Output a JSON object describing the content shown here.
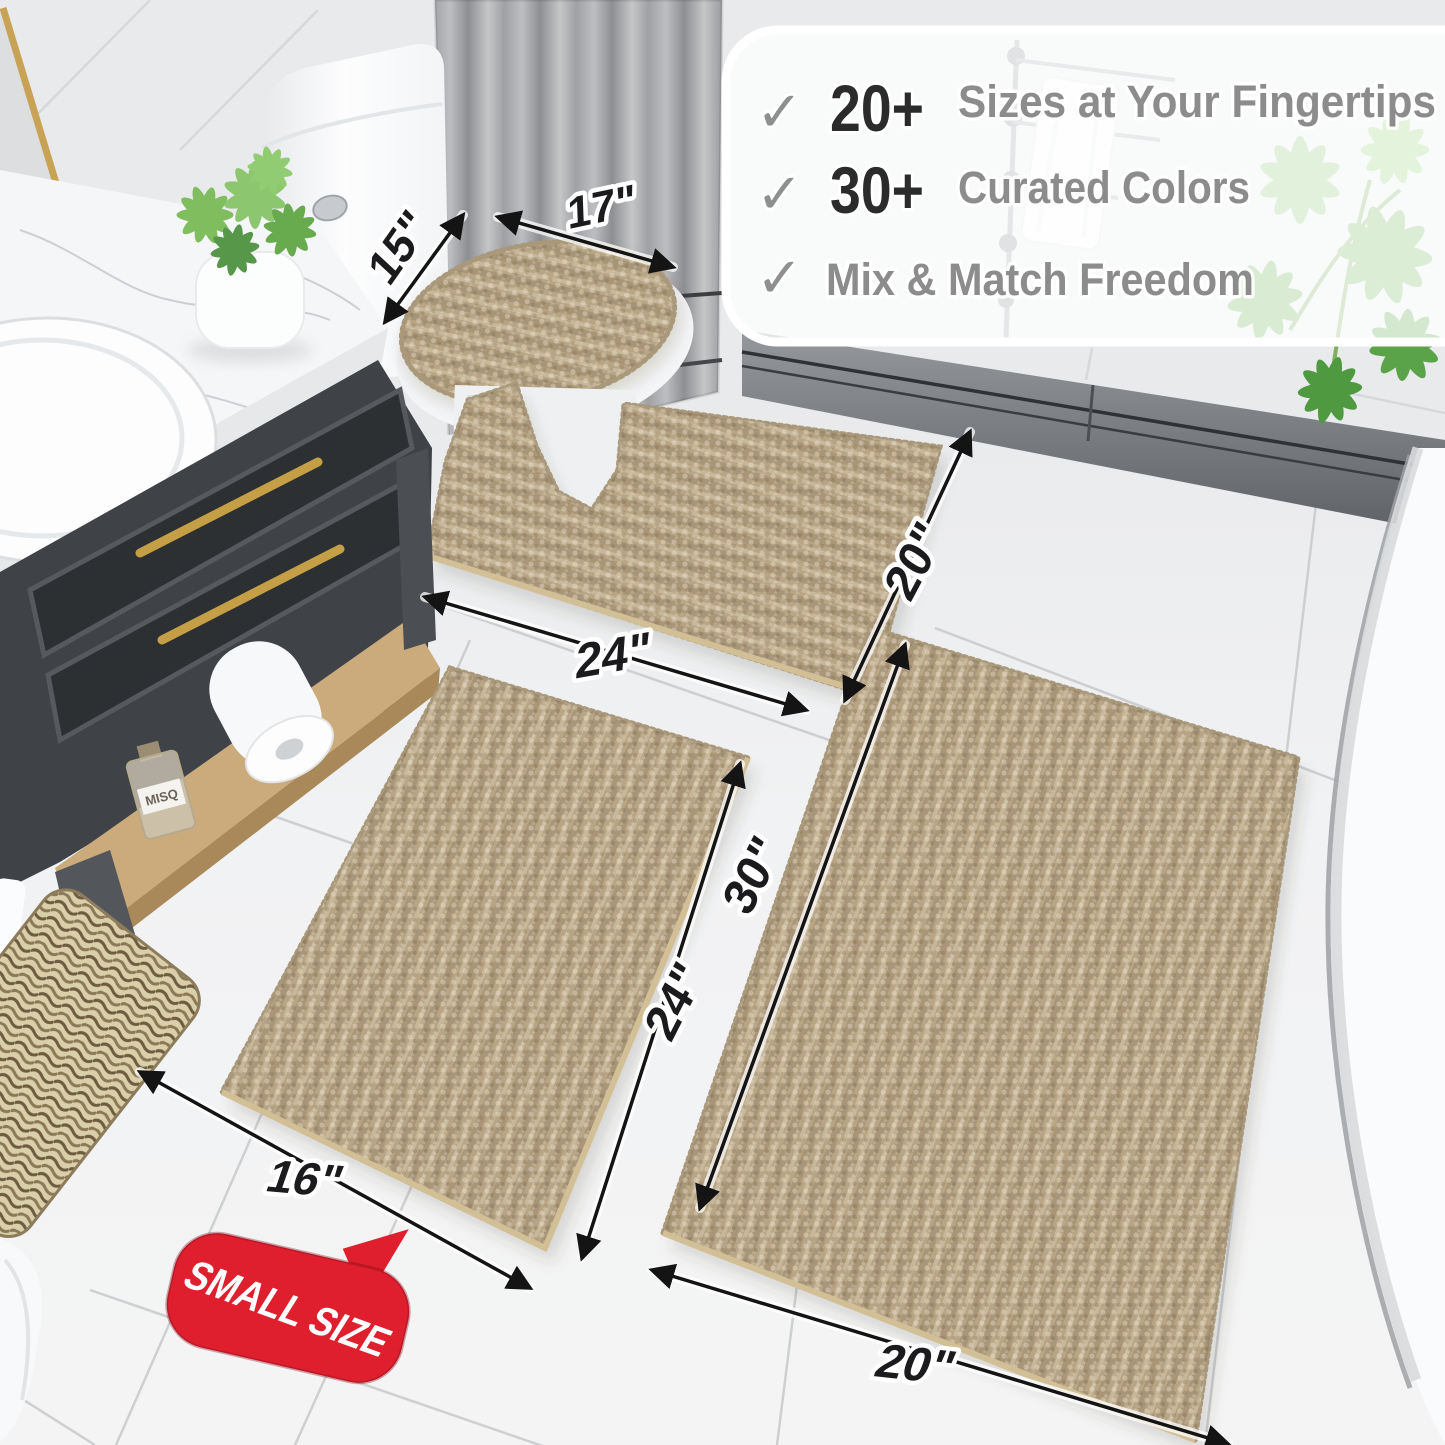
{
  "callout": {
    "check_icon": "✓",
    "items": [
      {
        "count": "20+",
        "label": "Sizes at Your Fingertips"
      },
      {
        "count": "30+",
        "label": "Curated Colors"
      },
      {
        "count": "",
        "label": "Mix & Match Freedom"
      }
    ]
  },
  "dimensions": {
    "lid_width": "15\"",
    "lid_length": "17\"",
    "contour_width": "24\"",
    "contour_depth": "20\"",
    "runner_length": "30\"",
    "small_length": "24\"",
    "small_width": "16\"",
    "runner_width": "20\""
  },
  "size_badge": "SMALL SIZE",
  "shelf_bottle_label": "MISQ",
  "colors": {
    "mat_base": "#b7a585",
    "badge_red": "#df1f2d",
    "accent_gold": "#c59f45",
    "label_ink": "#1b1b1d",
    "feature_gray": "#8c8c8c",
    "number_ink": "#2b2b2c",
    "check_gray": "#8f8f8f"
  }
}
